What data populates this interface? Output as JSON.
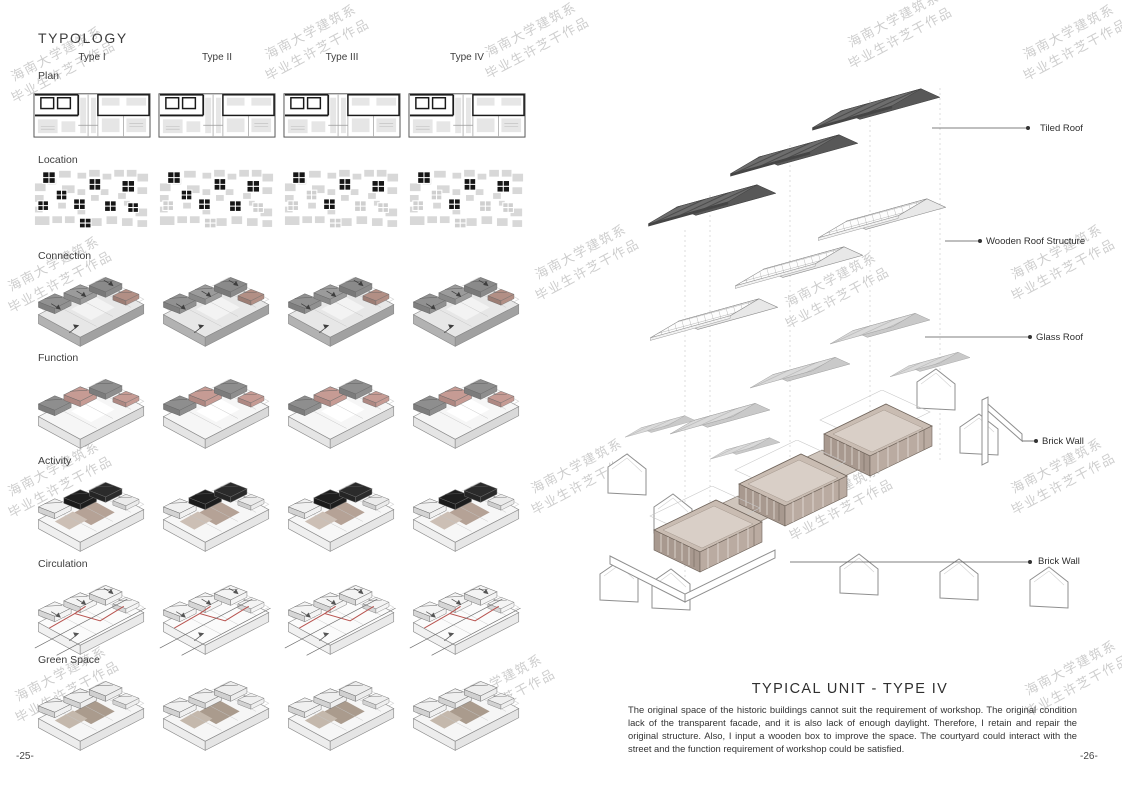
{
  "page": {
    "left_number": "-25-",
    "right_number": "-26-"
  },
  "typology": {
    "title": "TYPOLOGY",
    "column_headers": [
      "Type I",
      "Type II",
      "Type III",
      "Type IV"
    ],
    "row_labels": [
      "Plan",
      "Location",
      "Connection",
      "Function",
      "Activity",
      "Circulation",
      "Green Space"
    ]
  },
  "detail": {
    "title": "TYPICAL UNIT - TYPE IV",
    "description": "The original space of the historic buildings cannot suit the requirement of workshop. The original condition lack of the transparent facade, and it is also lack of enough daylight. Therefore, I retain and repair the original structure. Also, I input a wooden box to improve the space. The courtyard could interact with the street and the function requirement of workshop could be satisfied.",
    "callouts": [
      "Tiled Roof",
      "Wooden Roof Structure",
      "Glass Roof",
      "Brick Wall",
      "Brick Wall"
    ]
  },
  "watermark": {
    "line1": "海南大学建筑系",
    "line2": "毕业生许芝干作品"
  },
  "colors": {
    "tiled_roof": "#6d6d6d",
    "building_tan": "#a8998f",
    "function_accent_pink": "#c69b94",
    "activity_accent_black": "#1e1e1e",
    "circulation_path_red": "#b85450",
    "map_highlight_black": "#161616",
    "map_background_gray": "#d8d8d8",
    "watermark_gray": "#a6a6a6"
  }
}
